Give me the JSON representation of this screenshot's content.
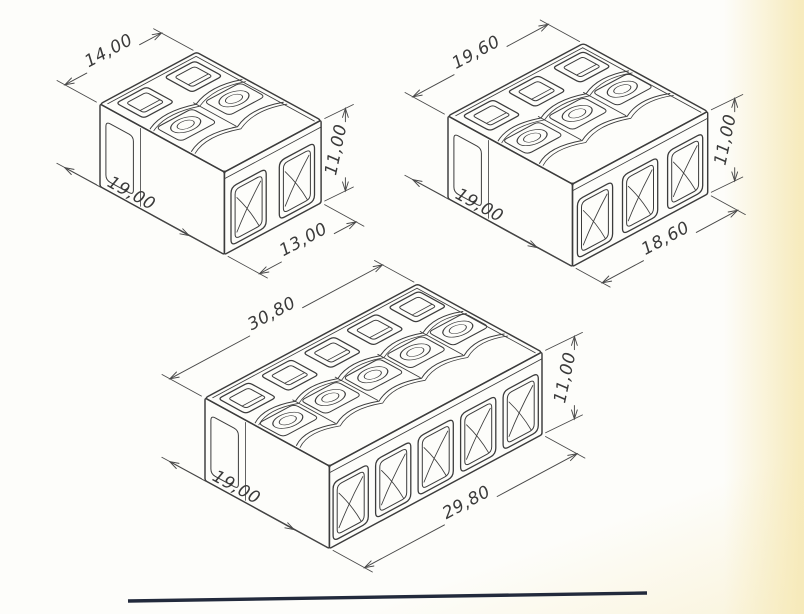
{
  "page": {
    "background": "#fdfdfa",
    "right_band_color": "#f6e9b7",
    "ink_color": "#3c3c3c",
    "dim_ink_color": "#484848",
    "footer_rule_color": "#222a3c"
  },
  "drawing": {
    "title": "Push-wire connector dimensional drawing",
    "decimal_style": "comma",
    "connectors": [
      {
        "name": "2-pole connector",
        "poles": 2,
        "width_mm": 14.0,
        "depth_mm": 19.0,
        "height_mm": 11.0,
        "front_width_mm": 13.0,
        "labels": {
          "top_width": "14,00",
          "depth": "19,00",
          "height": "11,00",
          "front_width": "13,00"
        },
        "origin_px": [
          100,
          104
        ]
      },
      {
        "name": "3-pole connector",
        "poles": 3,
        "width_mm": 19.6,
        "depth_mm": 19.0,
        "height_mm": 11.0,
        "front_width_mm": 18.6,
        "labels": {
          "top_width": "19,60",
          "depth": "19,00",
          "height": "11,00",
          "front_width": "18,60"
        },
        "origin_px": [
          448,
          116
        ]
      },
      {
        "name": "5-pole connector",
        "poles": 5,
        "width_mm": 30.8,
        "depth_mm": 19.0,
        "height_mm": 11.0,
        "front_width_mm": 29.8,
        "labels": {
          "top_width": "30,80",
          "depth": "19,00",
          "height": "11,00",
          "front_width": "29,80"
        },
        "origin_px": [
          205,
          398
        ]
      }
    ]
  },
  "footer_rule": {
    "x1": 128,
    "y1": 601,
    "x2": 647,
    "y2": 593,
    "stroke_width": 3.4
  }
}
